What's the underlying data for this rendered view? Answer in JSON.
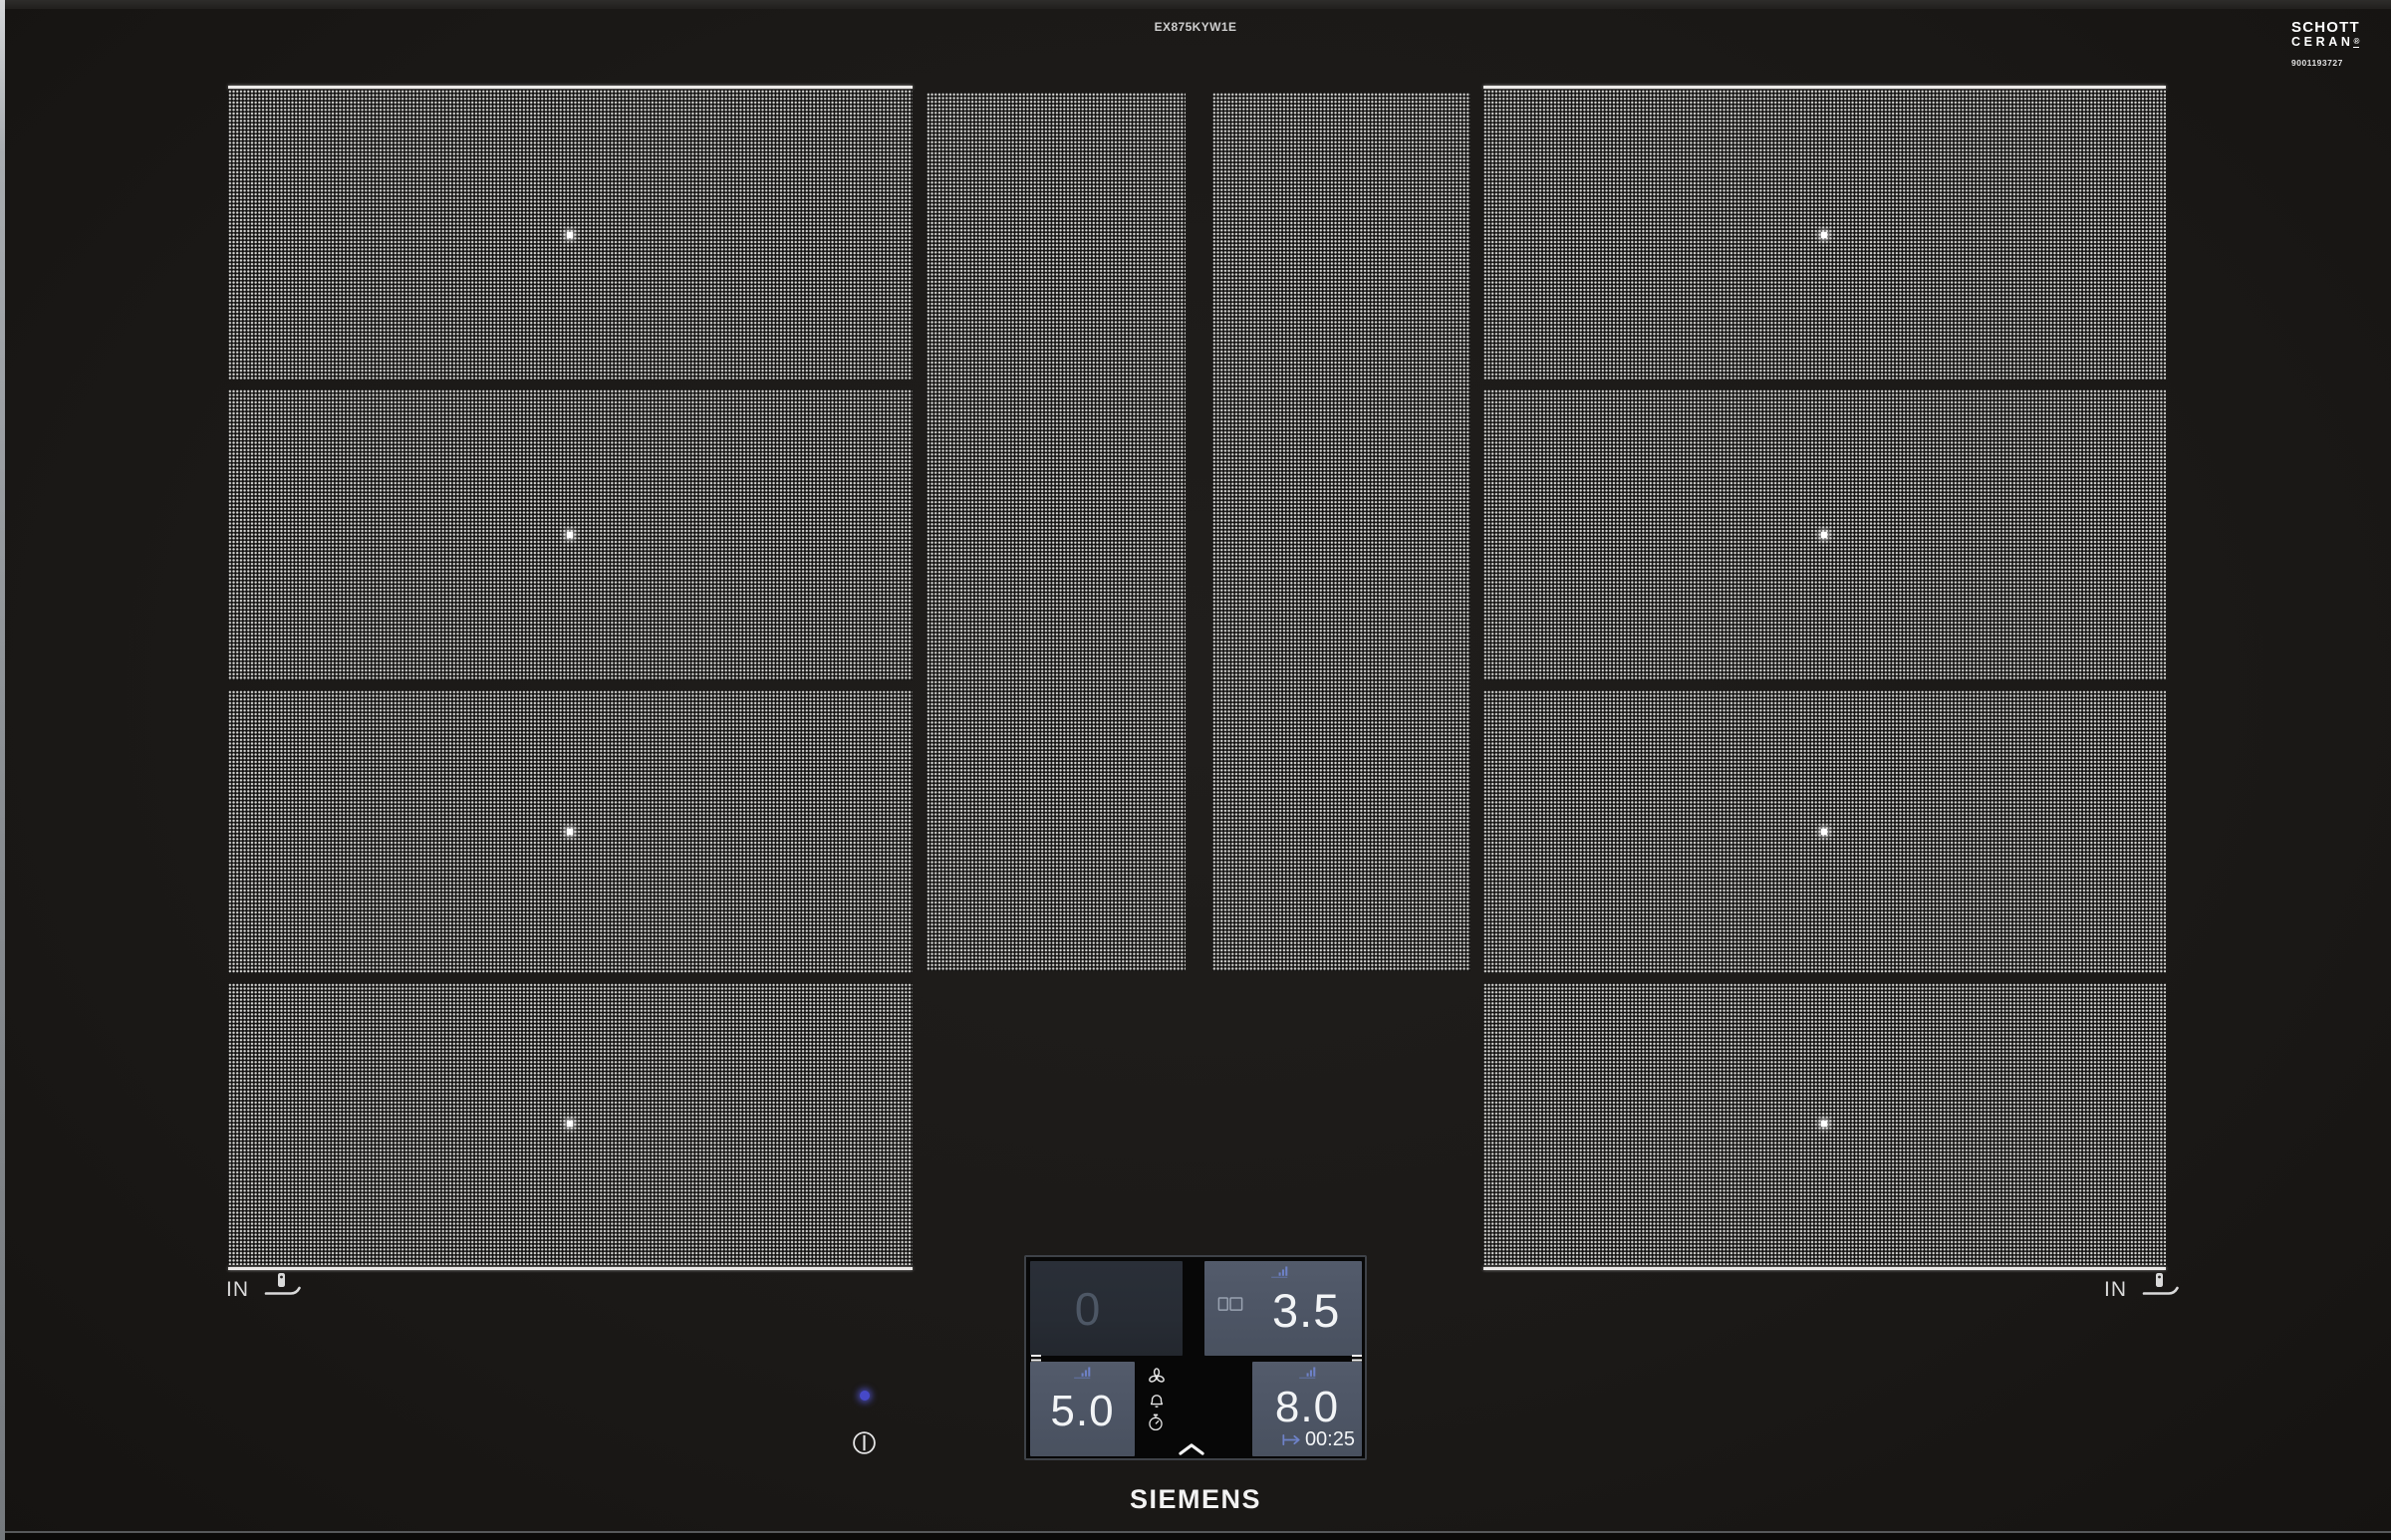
{
  "header": {
    "model": "EX875KYW1E"
  },
  "glass_logo": {
    "line1": "SCHOTT",
    "line2": "CERAN",
    "reg": "®",
    "code": "9001193727"
  },
  "markers": {
    "left": "IN",
    "right": "IN"
  },
  "panel": {
    "rear_left": {
      "value": "0"
    },
    "rear_right": {
      "value": "3.5"
    },
    "front_left": {
      "value": "5.0"
    },
    "front_right": {
      "value": "8.0",
      "timer": "00:25"
    }
  },
  "icons": {
    "power_level": "bar-chart-ascending",
    "bridge": "two-joined-rectangles",
    "fan": "three-blade-fan",
    "alarm": "bell",
    "timer": "stopwatch",
    "expand": "chevron-up",
    "timer_end": "arrow-from-bar",
    "power": "circle-with-line",
    "pan_sensor": "pan-with-probe"
  },
  "footer": {
    "brand": "SIEMENS"
  },
  "colors": {
    "accent_blue": "#6e82c8",
    "tile_active": "#4d5565",
    "tile_inactive": "#272c34",
    "digit": "#f2f4f6",
    "indicator_dot": "#4649c8"
  }
}
